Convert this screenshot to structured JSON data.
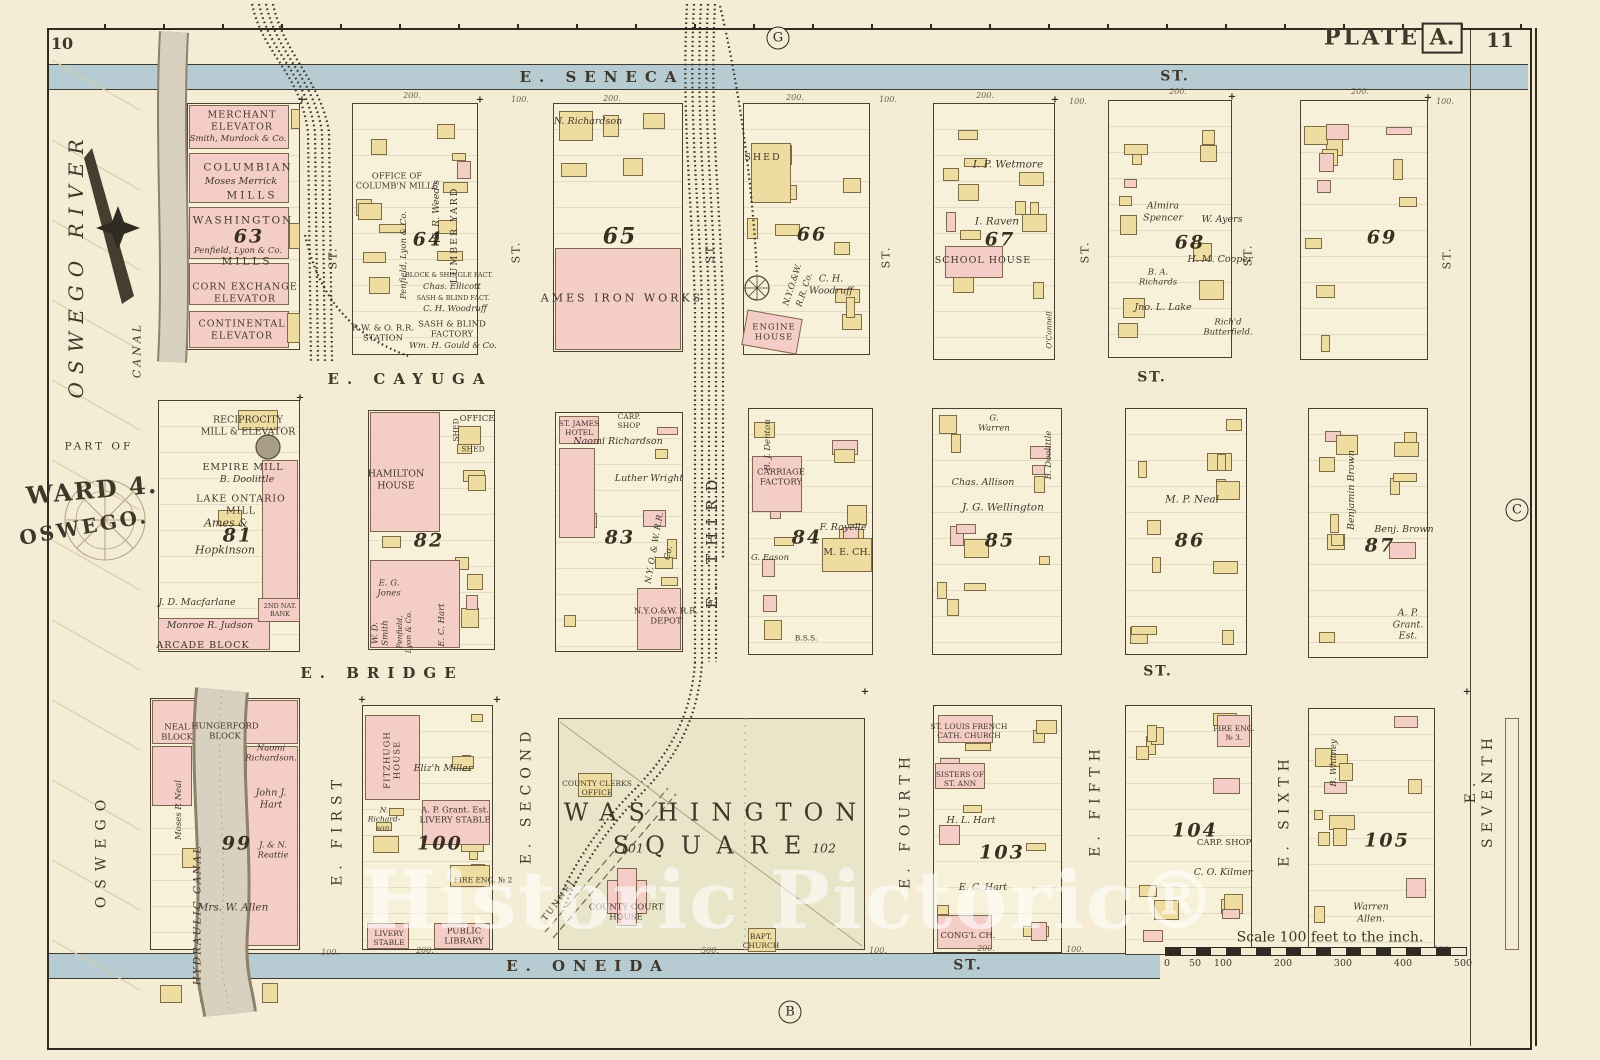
{
  "page": {
    "left_no": "10",
    "plate_word": "PLATE",
    "plate_letter": "A.",
    "right_no": "11"
  },
  "markers": {
    "top": "G",
    "bottom": "B",
    "right": "C"
  },
  "margin": {
    "river": "OSWEGO RIVER",
    "canal": "CANAL",
    "part_of": "PART OF",
    "ward": "WARD 4.",
    "city": "OSWEGO.",
    "oswego": "OSWEGO",
    "hydraulic": "HYDRAULIC CANAL"
  },
  "streets": {
    "seneca": "E. SENECA",
    "cayuga": "E. CAYUGA",
    "bridge": "E. BRIDGE",
    "oneida": "E. ONEIDA",
    "st": "ST.",
    "first": "E. FIRST",
    "second": "E. SECOND",
    "third": "E. THIRD",
    "fourth": "E. FOURTH",
    "fifth": "E. FIFTH",
    "sixth": "E. SIXTH",
    "seventh": "E. SEVENTH"
  },
  "dims": {
    "d100": "100.",
    "d200": "200.",
    "d300": "300.",
    "d500": "500."
  },
  "blocks": {
    "b63": {
      "num": "63",
      "merchant": "MERCHANT\nELEVATOR",
      "merchant_owner": "Smith, Murdock & Co.",
      "columbian": "COLUMBIAN",
      "columbian_owner": "Moses Merrick",
      "mills1": "MILLS",
      "washington": "WASHINGTON",
      "washington_owner": "Penfield, Lyon & Co.",
      "mills2": "MILLS",
      "corn": "CORN EXCHANGE\nELEVATOR",
      "continental": "CONTINENTAL\nELEVATOR"
    },
    "b64": {
      "num": "64",
      "office": "OFFICE OF\nCOLUMB'N MILLS",
      "penfield": "Penfield, Lyon & Co.",
      "weed": "E. R. Weed's",
      "lumber": "LUMBER YARD",
      "block_shingle": "BLOCK & SHINGLE FACT.",
      "ellicott": "Chas. Ellicott",
      "sash_fact": "SASH & BLIND FACT.",
      "woodruff": "C. H. Woodruff",
      "station": "R.W. & O. R.R.\nSTATION",
      "sash_factory": "SASH & BLIND\nFACTORY",
      "gould": "Wm. H. Gould & Co."
    },
    "b65": {
      "num": "65",
      "richardson": "N. Richardson",
      "ames": "AMES IRON WORKS"
    },
    "b66": {
      "num": "66",
      "shed": "SHED",
      "rr": "N.Y.O.&W.",
      "rr2": "R.R. Co.",
      "woodruff": "C. H.\nWoodruff",
      "engine": "ENGINE\nHOUSE"
    },
    "b67": {
      "num": "67",
      "wetmore": "I. P. Wetmore",
      "raven": "I. Raven",
      "school": "SCHOOL HOUSE",
      "oconnell": "O'Connell"
    },
    "b68": {
      "num": "68",
      "spencer": "Almira\nSpencer",
      "ayers": "W. Ayers",
      "cooper": "H. M. Cooper",
      "richards": "B. A.\nRichards",
      "lake": "Jno. L. Lake",
      "butterfield": "Rich'd\nButterfield."
    },
    "b69": {
      "num": "69"
    },
    "b81": {
      "num": "81",
      "reciprocity": "RECIPROCITY\nMILL & ELEVATOR",
      "empire": "EMPIRE MILL",
      "doolittle": "B. Doolittle",
      "lake_ontario": "LAKE ONTARIO\nMILL",
      "ames": "Ames &",
      "hopkinson": "Hopkinson",
      "macfarlane": "J. D. Macfarlane",
      "bank": "2ND NAT.\nBANK",
      "judson": "Monroe R. Judson",
      "arcade": "ARCADE BLOCK"
    },
    "b82": {
      "num": "82",
      "office": "OFFICE",
      "shed1": "SHED",
      "shed2": "SHED",
      "hamilton": "HAMILTON\nHOUSE",
      "jones": "E. G.\nJones",
      "smith": "W. D.\nSmith",
      "penfield": "Penfield,\nLyon & Co.",
      "hart": "E. C. Hart"
    },
    "b83": {
      "num": "83",
      "hotel": "ST. JAMES\nHOTEL",
      "carp": "CARP.\nSHOP",
      "richardson": "Naomi Richardson",
      "wright": "Luther Wright",
      "rr": "N.Y. O. & W. R.R.",
      "rr2": "Co.",
      "depot": "N.Y.O.&W. R.R.\nDEPOT"
    },
    "b84": {
      "num": "84",
      "denton": "B. J. Denton",
      "carriage": "CARRIAGE\nFACTORY",
      "rayelle": "F. Rayelle",
      "eason": "G. Eason",
      "church": "M. E. CH.",
      "bss": "B.S.S."
    },
    "b85": {
      "num": "85",
      "warren": "G.\nWarren",
      "allison": "Chas. Allison",
      "doolittle": "B. Doolittle",
      "wellington": "J. G. Wellington"
    },
    "b86": {
      "num": "86",
      "neal": "M. P. Neal"
    },
    "b87": {
      "num": "87",
      "brown_v": "Benjamin Brown",
      "brown": "Benj. Brown",
      "grant": "A. P.\nGrant.\nEst."
    },
    "b99": {
      "num": "99",
      "neal_block": "NEAL\nBLOCK",
      "hungerford": "HUNGERFORD\nBLOCK",
      "richardson": "Naomi\nRichardson.",
      "neal": "Moses P. Neal",
      "hart": "John J.\nHart",
      "reattie": "J. & N.\nReattie",
      "allen": "Mrs. W. Allen"
    },
    "b100": {
      "num": "100",
      "fitzhugh": "FITZHUGH\nHOUSE",
      "richardson": "N.\nRichard-\nson.",
      "miller": "Eliz'h Miller",
      "grant": "A. P. Grant. Est.\nLIVERY STABLE",
      "fire": "FIRE ENG. № 2",
      "library": "PUBLIC\nLIBRARY",
      "livery": "LIVERY\nSTABLE"
    },
    "b103": {
      "num": "103",
      "church": "ST. LOUIS FRENCH\nCATH. CHURCH",
      "sisters": "SISTERS OF\nST. ANN",
      "hart1": "H. L. Hart",
      "hart2": "E. C. Hart",
      "cong": "CONG'L CH."
    },
    "b104": {
      "num": "104",
      "fire": "FIRE ENG.\n№ 3.",
      "carp": "CARP. SHOP",
      "kilmer": "C. O. Kilmer"
    },
    "b105": {
      "num": "105",
      "whitney": "B. Whitney",
      "allen": "Warren\nAllen."
    }
  },
  "square": {
    "n1": "101",
    "n2": "102",
    "name1": "WASHINGTON",
    "name2": "SQUARE",
    "clerk": "COUNTY CLERKS\nOFFICE",
    "court": "COUNTY COURT\nHOUSE",
    "church": "BAPT.\nCHURCH",
    "tunnel": "TUNNEL"
  },
  "scale": {
    "caption": "Scale 100 feet to the inch.",
    "ticks": [
      "0",
      "50",
      "100",
      "200",
      "300",
      "400",
      "500"
    ]
  },
  "watermark": "Historic Pictoric®",
  "colors": {
    "paper": "#f4ecd5",
    "building_yellow": "#eedca1",
    "building_pink": "#f4cdc6",
    "street_water": "#b6ccd2",
    "ink": "#3c3528"
  }
}
